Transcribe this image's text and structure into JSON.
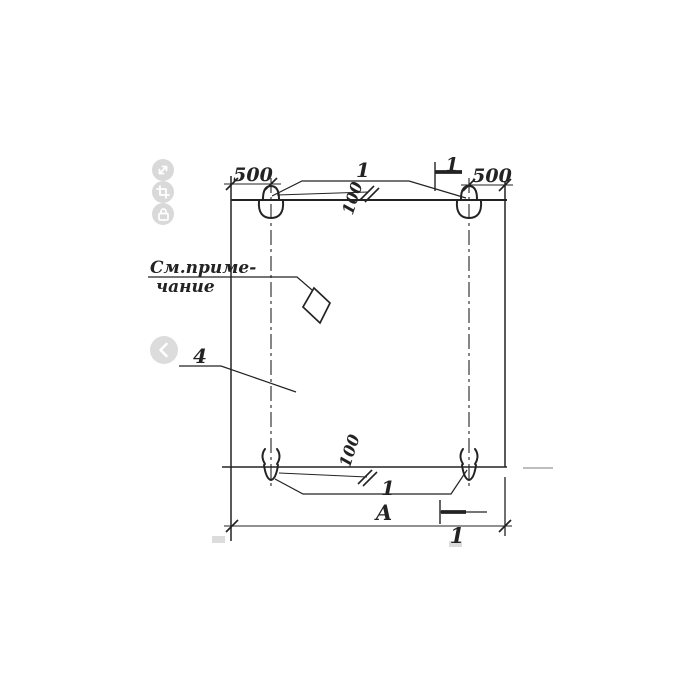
{
  "colors": {
    "paper": "#ffffff",
    "ink": "#232323",
    "faint_artifact": "#bdbdbd",
    "control_background": "#d9d9d9",
    "control_glyph": "#ffffff"
  },
  "viewer": {
    "tools": [
      {
        "name": "fullscreen",
        "icon": "expand-icon"
      },
      {
        "name": "crop",
        "icon": "crop-icon"
      },
      {
        "name": "lock",
        "icon": "lock-icon"
      }
    ],
    "nav_previous": {
      "name": "previous",
      "icon": "chevron-left-icon"
    }
  },
  "drawing": {
    "dims": {
      "top_left_offset": "500",
      "top_right_offset": "500",
      "top_inset": "100",
      "bottom_inset": "100",
      "overall_width": "А"
    },
    "callouts": {
      "top_loops": "1",
      "bottom_loops": "1",
      "section_mark_top": "1",
      "section_mark_bottom": "1",
      "panel_item": "4"
    },
    "note": {
      "line1": "См.приме-",
      "line2": "чание"
    }
  }
}
